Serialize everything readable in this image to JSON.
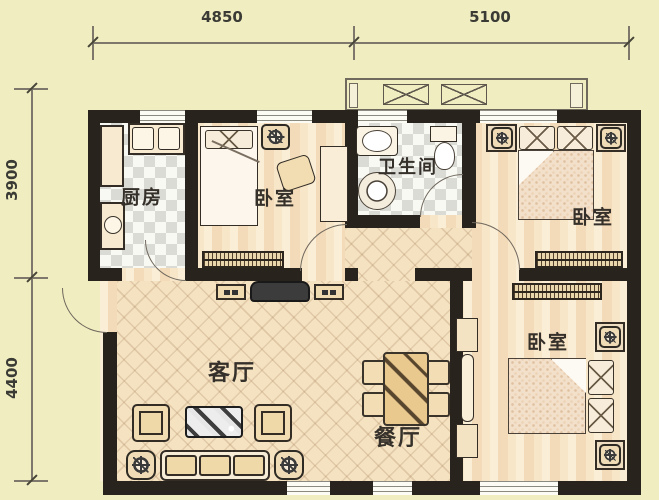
{
  "plan_title": "three-bedroom apartment floor plan",
  "dimensions": {
    "top": [
      "4850",
      "5100"
    ],
    "left": [
      "3900",
      "4400"
    ]
  },
  "rooms": {
    "kitchen": "厨房",
    "bedroom_top": "卧室",
    "bathroom": "卫生间",
    "bedroom_right": "卧室",
    "living": "客厅",
    "dining": "餐厅",
    "bedroom_bottom": "卧室"
  },
  "colors": {
    "background": "#f0edc1",
    "wall": "#29231e",
    "wood_floor": "#f6e2c2",
    "tile_light": "#f9f9f3",
    "tile_dark": "#dbdbd5",
    "furniture_fill": "#f2ddb2",
    "outline": "#332d26",
    "hatch": "#55422c",
    "label_text": "#35302a"
  }
}
